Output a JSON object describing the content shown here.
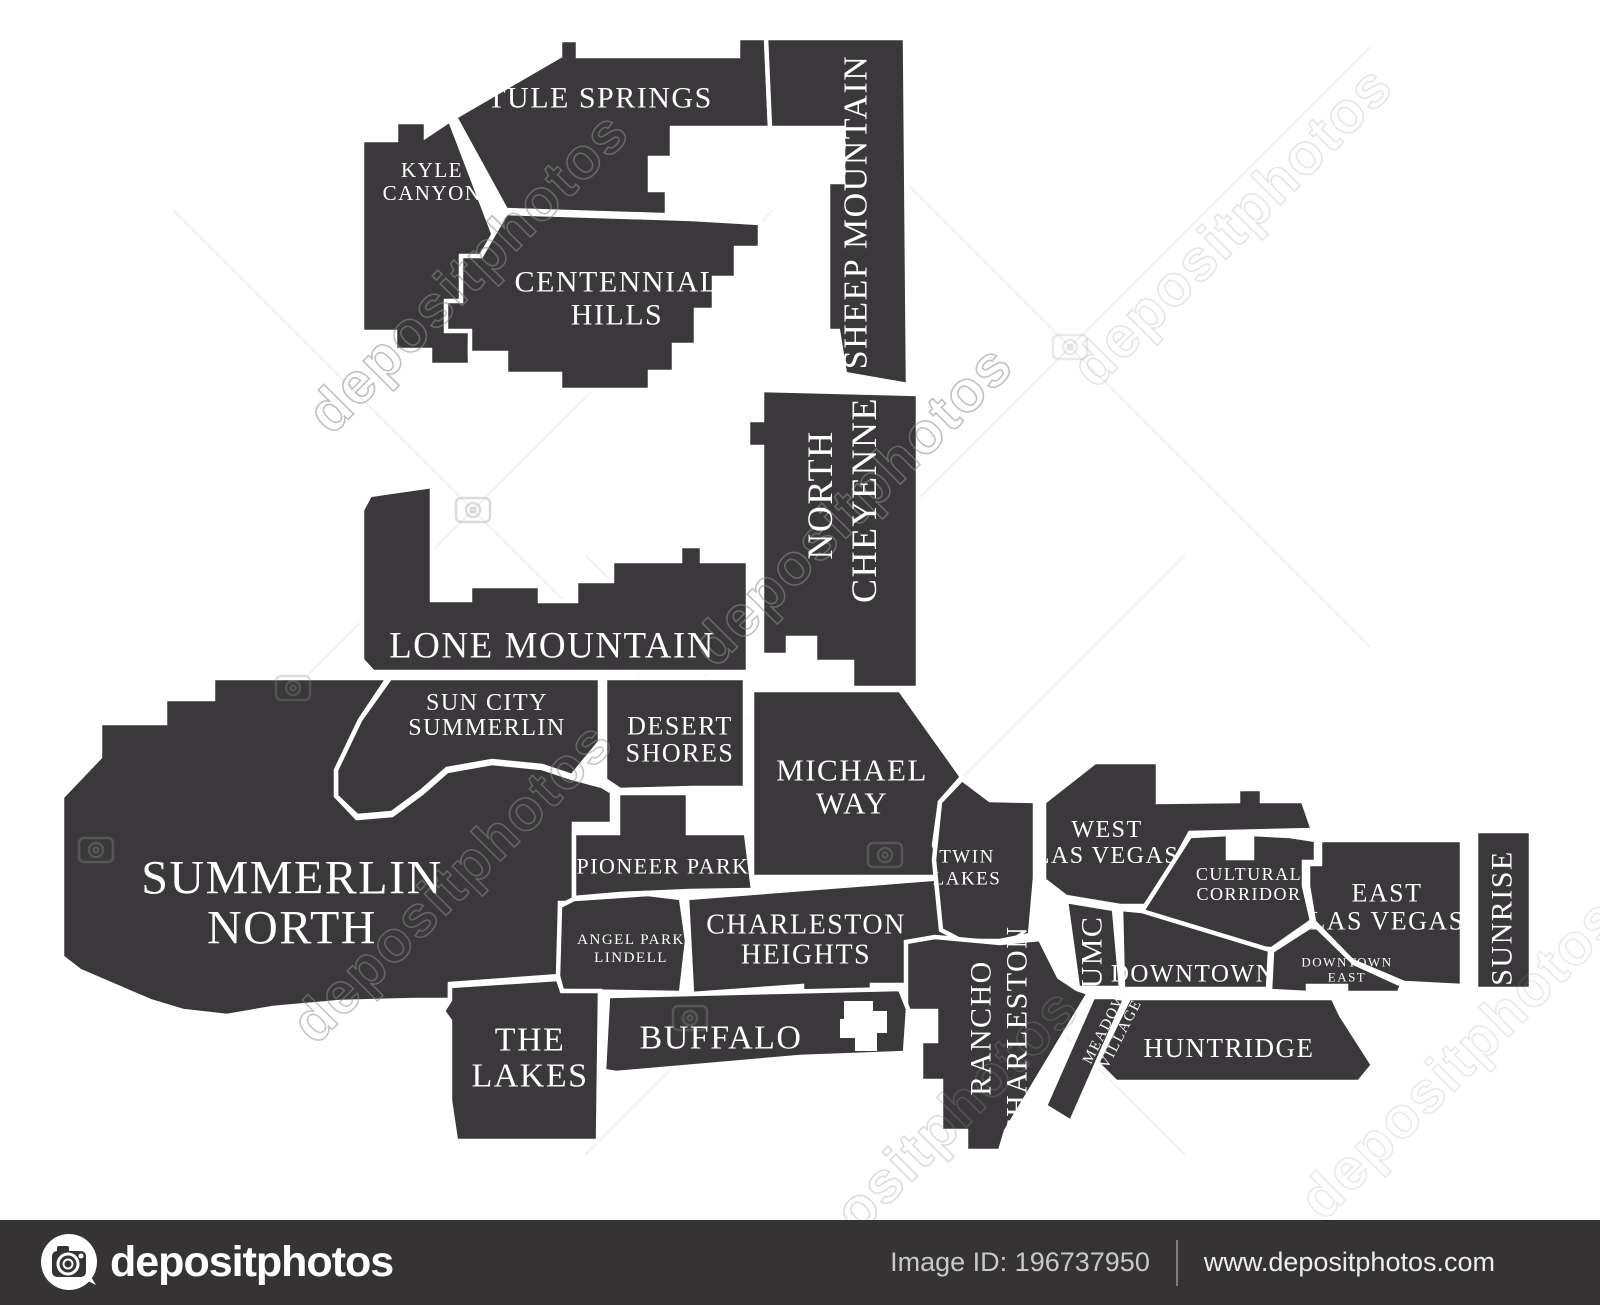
{
  "colors": {
    "map_fill": "#3a383a",
    "map_border": "#ffffff",
    "label": "#ffffff",
    "page_bg": "#ffffff",
    "watermark": "#8f8f8f",
    "footer_bg": "#353334",
    "footer_text_dim": "#c9c9c9",
    "footer_text": "#ededed"
  },
  "map": {
    "city": "Las Vegas neighborhoods",
    "neighborhood_labels": [
      {
        "id": "tule-springs",
        "line": "TULE SPRINGS",
        "x": 600,
        "y": 98,
        "rot": 0,
        "size": 30
      },
      {
        "id": "kyle-canyon",
        "line": "KYLE",
        "x": 432,
        "y": 170,
        "rot": 0,
        "size": 21
      },
      {
        "id": "kyle-canyon",
        "line": "CANYON",
        "x": 432,
        "y": 193,
        "rot": 0,
        "size": 21
      },
      {
        "id": "centennial-hills",
        "line": "CENTENNIAL",
        "x": 617,
        "y": 282,
        "rot": 0,
        "size": 30
      },
      {
        "id": "centennial-hills",
        "line": "HILLS",
        "x": 617,
        "y": 315,
        "rot": 0,
        "size": 30
      },
      {
        "id": "sheep-mountain",
        "line": "SHEEP MOUNTAIN",
        "x": 856,
        "y": 212,
        "rot": -90,
        "size": 34
      },
      {
        "id": "north-cheyenne",
        "line": "NORTH",
        "x": 820,
        "y": 495,
        "rot": -90,
        "size": 36
      },
      {
        "id": "north-cheyenne",
        "line": "CHEYENNE",
        "x": 864,
        "y": 500,
        "rot": -90,
        "size": 36
      },
      {
        "id": "lone-mountain",
        "line": "LONE MOUNTAIN",
        "x": 552,
        "y": 646,
        "rot": 0,
        "size": 37
      },
      {
        "id": "sun-city-summerlin",
        "line": "SUN CITY",
        "x": 487,
        "y": 703,
        "rot": 0,
        "size": 24
      },
      {
        "id": "sun-city-summerlin",
        "line": "SUMMERLIN",
        "x": 487,
        "y": 728,
        "rot": 0,
        "size": 24
      },
      {
        "id": "desert-shores",
        "line": "DESERT",
        "x": 680,
        "y": 726,
        "rot": 0,
        "size": 26
      },
      {
        "id": "desert-shores",
        "line": "SHORES",
        "x": 680,
        "y": 753,
        "rot": 0,
        "size": 26
      },
      {
        "id": "michael-way",
        "line": "MICHAEL",
        "x": 852,
        "y": 770,
        "rot": 0,
        "size": 31
      },
      {
        "id": "michael-way",
        "line": "WAY",
        "x": 852,
        "y": 803,
        "rot": 0,
        "size": 31
      },
      {
        "id": "summerlin-north",
        "line": "SUMMERLIN",
        "x": 292,
        "y": 878,
        "rot": 0,
        "size": 48
      },
      {
        "id": "summerlin-north",
        "line": "NORTH",
        "x": 292,
        "y": 928,
        "rot": 0,
        "size": 48
      },
      {
        "id": "pioneer-park",
        "line": "PIONEER PARK",
        "x": 663,
        "y": 866,
        "rot": 0,
        "size": 22
      },
      {
        "id": "angel-park-lindell",
        "line": "ANGEL PARK",
        "x": 631,
        "y": 940,
        "rot": 0,
        "size": 15
      },
      {
        "id": "angel-park-lindell",
        "line": "LINDELL",
        "x": 631,
        "y": 958,
        "rot": 0,
        "size": 15
      },
      {
        "id": "charleston-heights",
        "line": "CHARLESTON",
        "x": 806,
        "y": 925,
        "rot": 0,
        "size": 28
      },
      {
        "id": "charleston-heights",
        "line": "HEIGHTS",
        "x": 806,
        "y": 955,
        "rot": 0,
        "size": 28
      },
      {
        "id": "twin-lakes",
        "line": "TWIN",
        "x": 967,
        "y": 857,
        "rot": 0,
        "size": 19
      },
      {
        "id": "twin-lakes",
        "line": "LAKES",
        "x": 967,
        "y": 879,
        "rot": 0,
        "size": 19
      },
      {
        "id": "west-las-vegas",
        "line": "WEST",
        "x": 1107,
        "y": 830,
        "rot": 0,
        "size": 24
      },
      {
        "id": "west-las-vegas",
        "line": "LAS VEGAS",
        "x": 1107,
        "y": 856,
        "rot": 0,
        "size": 24
      },
      {
        "id": "cultural-corridor",
        "line": "CULTURAL",
        "x": 1249,
        "y": 874,
        "rot": 0,
        "size": 18
      },
      {
        "id": "cultural-corridor",
        "line": "CORRIDOR",
        "x": 1249,
        "y": 894,
        "rot": 0,
        "size": 18
      },
      {
        "id": "east-las-vegas",
        "line": "EAST",
        "x": 1387,
        "y": 893,
        "rot": 0,
        "size": 26
      },
      {
        "id": "east-las-vegas",
        "line": "LAS VEGAS",
        "x": 1387,
        "y": 921,
        "rot": 0,
        "size": 26
      },
      {
        "id": "sunrise",
        "line": "SUNRISE",
        "x": 1502,
        "y": 918,
        "rot": -90,
        "size": 30
      },
      {
        "id": "umc",
        "line": "UMC",
        "x": 1092,
        "y": 952,
        "rot": -90,
        "size": 30
      },
      {
        "id": "downtown",
        "line": "DOWNTOWN",
        "x": 1193,
        "y": 974,
        "rot": 0,
        "size": 25
      },
      {
        "id": "downtown-east",
        "line": "DOWNTOWN",
        "x": 1347,
        "y": 962,
        "rot": 0,
        "size": 13
      },
      {
        "id": "downtown-east",
        "line": "EAST",
        "x": 1347,
        "y": 977,
        "rot": 0,
        "size": 13
      },
      {
        "id": "rancho-charleston",
        "line": "RANCHO",
        "x": 981,
        "y": 1028,
        "rot": -90,
        "size": 30
      },
      {
        "id": "rancho-charleston",
        "line": "CHARLESTON",
        "x": 1017,
        "y": 1032,
        "rot": -90,
        "size": 30
      },
      {
        "id": "meadows-village",
        "line": "MEADOWS",
        "x": 1107,
        "y": 1024,
        "rot": -63,
        "size": 15
      },
      {
        "id": "meadows-village",
        "line": "VILLAGE",
        "x": 1121,
        "y": 1034,
        "rot": -63,
        "size": 15
      },
      {
        "id": "huntridge",
        "line": "HUNTRIDGE",
        "x": 1229,
        "y": 1048,
        "rot": 0,
        "size": 27
      },
      {
        "id": "the-lakes",
        "line": "THE",
        "x": 530,
        "y": 1040,
        "rot": 0,
        "size": 34
      },
      {
        "id": "the-lakes",
        "line": "LAKES",
        "x": 530,
        "y": 1076,
        "rot": 0,
        "size": 34
      },
      {
        "id": "buffalo",
        "line": "BUFFALO",
        "x": 721,
        "y": 1038,
        "rot": 0,
        "size": 34
      }
    ]
  },
  "watermark": {
    "brand": "depositphotos",
    "text_instances": [
      {
        "x": 468,
        "y": 272,
        "rot": -45,
        "size": 58,
        "opacity": 0.55
      },
      {
        "x": 852,
        "y": 505,
        "rot": -45,
        "size": 58,
        "opacity": 0.55
      },
      {
        "x": 452,
        "y": 882,
        "rot": -45,
        "size": 58,
        "opacity": 0.5
      },
      {
        "x": 1232,
        "y": 226,
        "rot": -45,
        "size": 58,
        "opacity": 0.22
      },
      {
        "x": 918,
        "y": 1148,
        "rot": -45,
        "size": 58,
        "opacity": 0.3
      },
      {
        "x": 1460,
        "y": 1058,
        "rot": -45,
        "size": 58,
        "opacity": 0.18
      }
    ],
    "camera_marks": [
      {
        "x": 96,
        "y": 850,
        "opacity": 0.35
      },
      {
        "x": 293,
        "y": 688,
        "opacity": 0.3
      },
      {
        "x": 473,
        "y": 510,
        "opacity": 0.3
      },
      {
        "x": 885,
        "y": 855,
        "opacity": 0.35
      },
      {
        "x": 690,
        "y": 1018,
        "opacity": 0.35
      },
      {
        "x": 1070,
        "y": 347,
        "opacity": 0.18
      }
    ]
  },
  "footer": {
    "logo_text": "depositphotos",
    "image_id": "Image ID: 196737950",
    "website": "www.depositphotos.com"
  }
}
